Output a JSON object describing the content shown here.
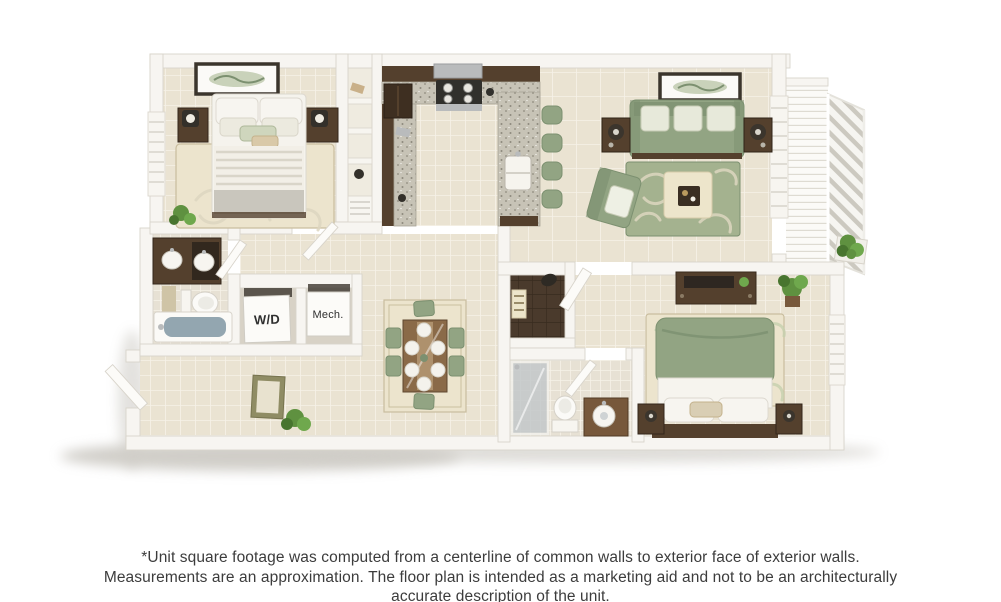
{
  "plan": {
    "labels": {
      "washer_dryer": "W/D",
      "mechanical": "Mech."
    }
  },
  "disclaimer": {
    "text": "*Unit square footage was computed from a centerline of common walls to exterior face of exterior walls. Measurements are an approximation. The floor plan is intended as a marketing aid and not to be an architecturally accurate description of the unit."
  },
  "colors": {
    "page_bg": "#ffffff",
    "wall": "#f7f5f1",
    "wall_edge": "#d8d4cb",
    "floor_tile": "#eae3d2",
    "floor_grout": "#f6f2e8",
    "bath_tile": "#e7e1d4",
    "wood_dark": "#4c3827",
    "wood_mid": "#77583b",
    "cabinet": "#54402d",
    "sage": "#92a483",
    "sage_dark": "#7c9070",
    "sage_light": "#c9d2ba",
    "rug_sage": "#a4b28f",
    "rug_cream": "#ece4cd",
    "cream": "#ede5cb",
    "granite": "#c7c3b6",
    "granite_dot": "#8e8a7d",
    "steel": "#b9bbbc",
    "charcoal": "#31302c",
    "tub_water": "#93a6b0",
    "plant": "#5f9140",
    "label_text": "#2f2f2f",
    "disclaimer_text": "#3c3c3c",
    "shadow": "#a29d92"
  }
}
